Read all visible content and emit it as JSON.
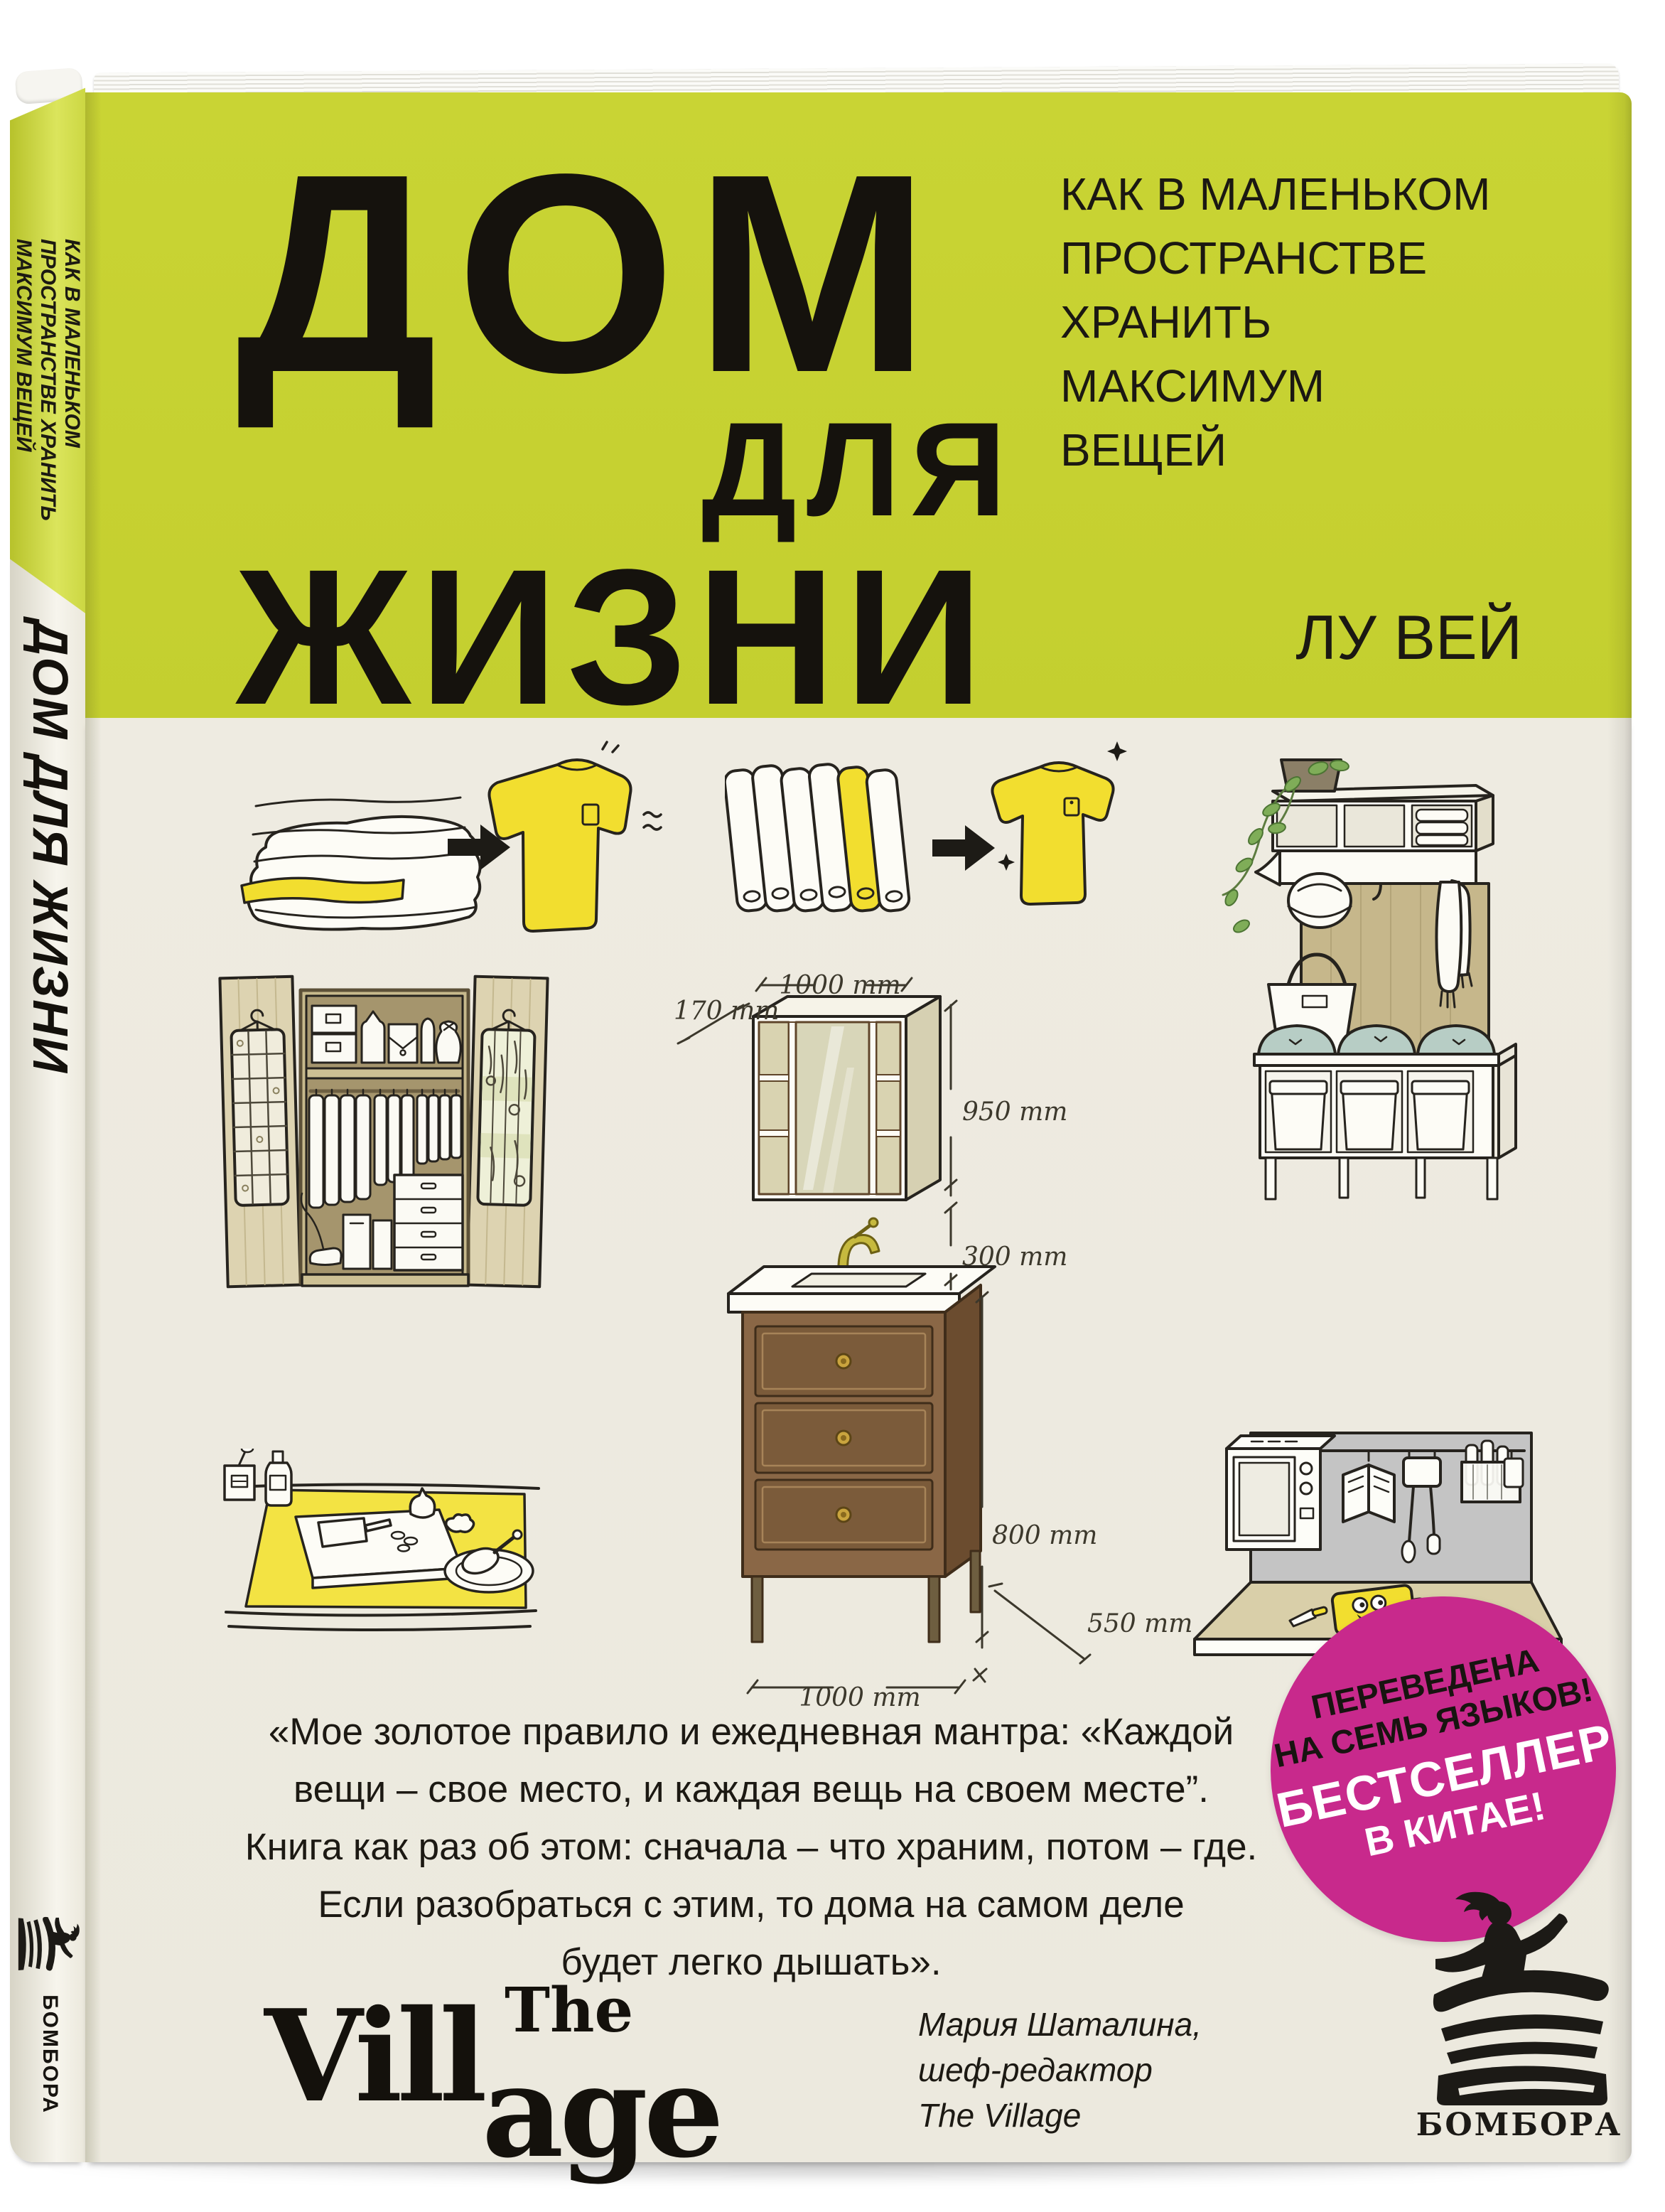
{
  "book": {
    "front": {
      "title_line_1": "ДОМ",
      "title_line_2": "ДЛЯ",
      "title_line_3": "ЖИЗНИ",
      "subtitle_line_1": "КАК В МАЛЕНЬКОМ",
      "subtitle_line_2": "ПРОСТРАНСТВЕ",
      "subtitle_line_3": "ХРАНИТЬ",
      "subtitle_line_4": "МАКСИМУМ",
      "subtitle_line_5": "ВЕЩЕЙ",
      "author": "ЛУ ВЕЙ"
    },
    "spine": {
      "subtitle_line_1": "КАК В МАЛЕНЬКОМ",
      "subtitle_line_2": "ПРОСТРАНСТВЕ ХРАНИТЬ",
      "subtitle_line_3": "МАКСИМУМ ВЕЩЕЙ",
      "title": "ДОМ ДЛЯ ЖИЗНИ",
      "publisher": "БОМБОРА"
    },
    "diagram_labels": {
      "depth_top": "170 mm",
      "width_top": "1000 mm",
      "cabinet_height": "950 mm",
      "gap_height": "300 mm",
      "vanity_height": "800 mm",
      "depth_bottom": "550 mm",
      "width_bottom": "1000 mm"
    },
    "quote": {
      "line_1": "«Мое золотое правило и ежедневная мантра: «Каждой",
      "line_2": "вещи – свое место, и каждая вещь на своем месте”.",
      "line_3": "Книга как раз об этом: сначала – что храним, потом – где.",
      "line_4": "Если разобраться с этим, то дома на самом деле",
      "line_5": "будет легко дышать»."
    },
    "village_logo": {
      "the": "The",
      "vill": "Vill",
      "age": "age"
    },
    "endorser": {
      "name": "Мария Шаталина,",
      "role": "шеф-редактор",
      "org": "The Village"
    },
    "badge": {
      "line_1": "ПЕРЕВЕДЕНА",
      "line_2": "НА СЕМЬ ЯЗЫКОВ!",
      "line_3": "БЕСТСЕЛЛЕР",
      "line_4": "В КИТАЕ!"
    },
    "publisher_logo_text": "БОМБОРА",
    "colors": {
      "cover_green": "#c8d334",
      "spine_green": "#d5df4b",
      "cover_cream": "#edeae0",
      "badge_pink": "#c8298c",
      "ink": "#171310"
    }
  }
}
